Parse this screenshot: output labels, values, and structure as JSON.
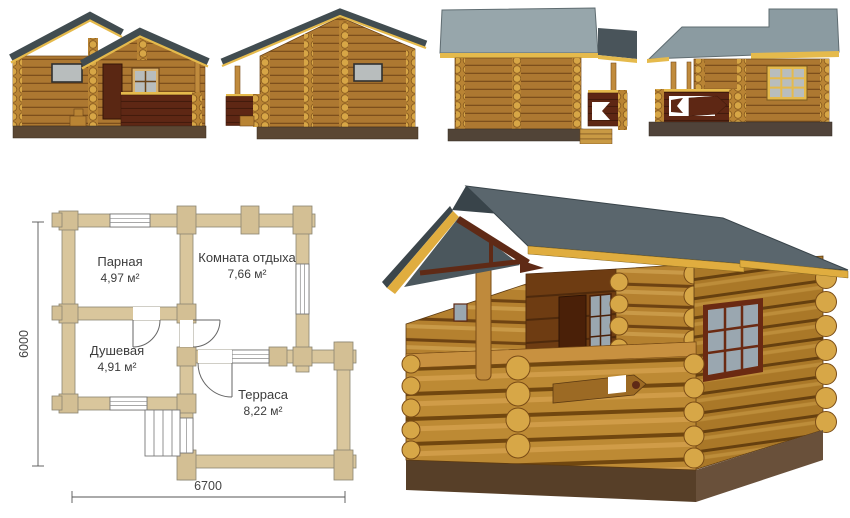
{
  "floor_plan": {
    "rooms": [
      {
        "name": "Парная",
        "area": "4,97 м²"
      },
      {
        "name": "Комната отдыха",
        "area": "7,66 м²"
      },
      {
        "name": "Душевая",
        "area": "4,91 м²"
      },
      {
        "name": "Терраса",
        "area": "8,22 м²"
      }
    ],
    "dimensions": {
      "width": "6700",
      "height": "6000"
    }
  },
  "colors": {
    "log_wall": "#ad7831",
    "log_shadow": "#7d4f1c",
    "log_end": "#d7a646",
    "roof_band_dark": "#414c50",
    "roof_light": "#97a6ab",
    "roof_3d": "#5a666d",
    "trim_yellow": "#e5ba4c",
    "railing_dark": "#5e2714",
    "foundation": "#5b4733",
    "plan_wall": "#d9c69c",
    "glass": "#b8bdbd"
  }
}
